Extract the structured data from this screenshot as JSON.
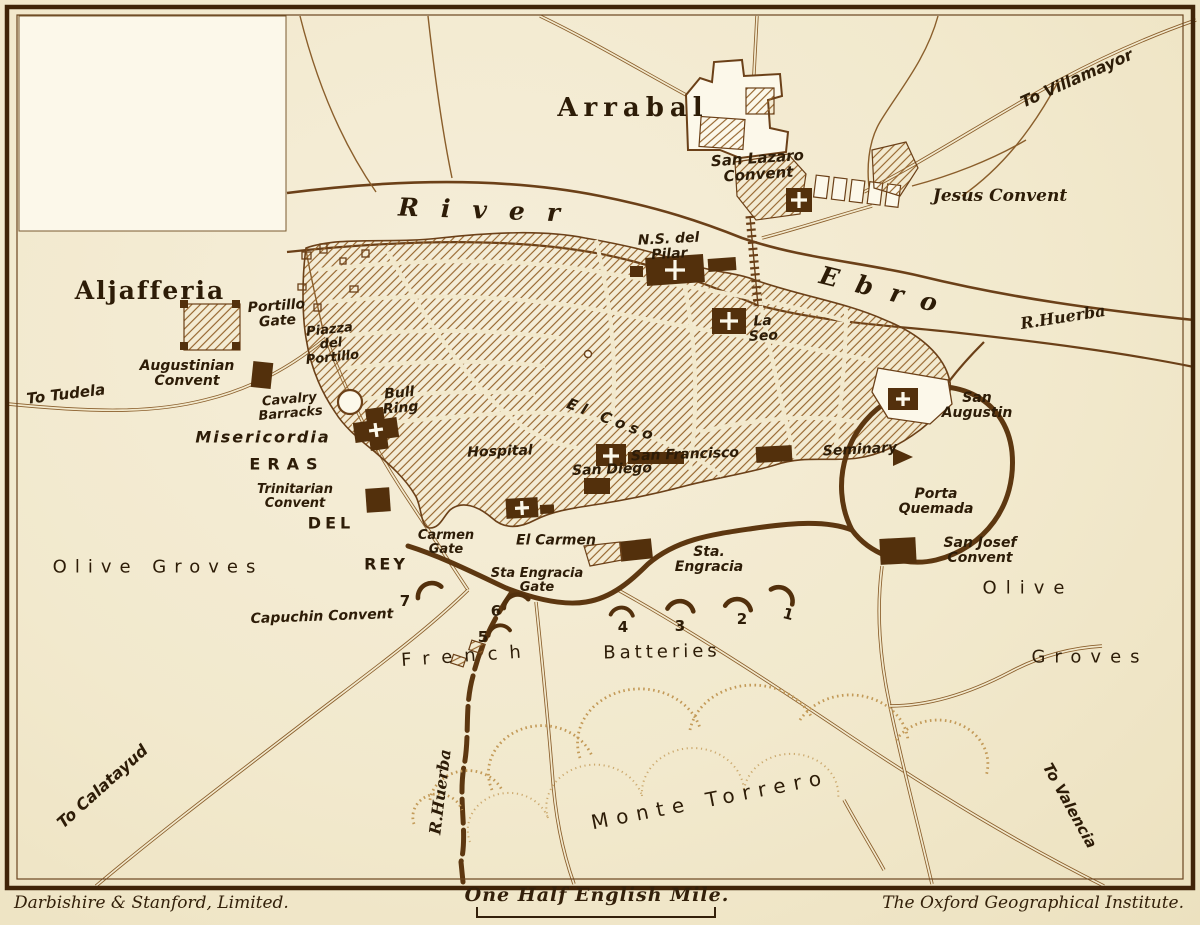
{
  "map": {
    "subject": "Siege map of Saragossa with French batteries",
    "labels": [
      {
        "id": "arrabal",
        "t": "Arrabal",
        "x": 633,
        "y": 109,
        "fs": 26,
        "ls": 6,
        "f": "serif",
        "w": 700
      },
      {
        "id": "river-word",
        "t": "River",
        "x": 490,
        "y": 211,
        "fs": 25,
        "ls": 22,
        "f": "serif",
        "it": 1,
        "w": 700,
        "rot": 2
      },
      {
        "id": "ebro-word",
        "t": "Ebro",
        "x": 887,
        "y": 292,
        "fs": 25,
        "ls": 18,
        "f": "serif",
        "it": 1,
        "w": 700,
        "rot": 14
      },
      {
        "id": "san-lazaro-convent",
        "t": "San Lazaro\nConvent",
        "x": 758,
        "y": 167,
        "fs": 15,
        "it": 1,
        "w": 700,
        "rot": -4
      },
      {
        "id": "to-villamayor",
        "t": "To Villamayor",
        "x": 1077,
        "y": 79,
        "fs": 16,
        "it": 1,
        "w": 600,
        "rot": -24
      },
      {
        "id": "jesus-convent",
        "t": "Jesus Convent",
        "x": 1000,
        "y": 196,
        "fs": 17,
        "f": "serif",
        "it": 1,
        "w": 600
      },
      {
        "id": "r-huerba-mouth",
        "t": "R.Huerba",
        "x": 1063,
        "y": 318,
        "fs": 16,
        "f": "serif",
        "it": 1,
        "w": 700,
        "rot": -9
      },
      {
        "id": "ns-del-pilar",
        "t": "N.S. del\nPilar",
        "x": 669,
        "y": 247,
        "fs": 14,
        "it": 1,
        "w": 700,
        "rot": -3
      },
      {
        "id": "la-seo",
        "t": "La\nSeo",
        "x": 763,
        "y": 329,
        "fs": 14,
        "it": 1,
        "w": 700,
        "rot": -3
      },
      {
        "id": "aljafferia",
        "t": "Aljafferia",
        "x": 150,
        "y": 291,
        "fs": 25,
        "ls": 2,
        "f": "serif",
        "w": 700
      },
      {
        "id": "portillo-gate",
        "t": "Portillo\nGate",
        "x": 277,
        "y": 314,
        "fs": 14,
        "it": 1,
        "w": 700,
        "rot": -4
      },
      {
        "id": "piazza-del-portillo",
        "t": "Piazza\ndel\nPortillo",
        "x": 331,
        "y": 344,
        "fs": 13,
        "it": 1,
        "w": 700,
        "rot": -6
      },
      {
        "id": "augustinian-convent",
        "t": "Augustinian\nConvent",
        "x": 187,
        "y": 374,
        "fs": 14,
        "it": 1,
        "w": 700
      },
      {
        "id": "to-tudela",
        "t": "To Tudela",
        "x": 66,
        "y": 395,
        "fs": 15,
        "it": 1,
        "w": 600,
        "rot": -7
      },
      {
        "id": "cavalry-barracks",
        "t": "Cavalry\nBarracks",
        "x": 290,
        "y": 407,
        "fs": 13,
        "it": 1,
        "w": 700,
        "rot": -5
      },
      {
        "id": "bull-ring",
        "t": "Bull\nRing",
        "x": 400,
        "y": 401,
        "fs": 14,
        "it": 1,
        "w": 700,
        "rot": -5
      },
      {
        "id": "misericordia",
        "t": "Misericordia",
        "x": 263,
        "y": 438,
        "fs": 16,
        "it": 1,
        "w": 700,
        "ls": 2
      },
      {
        "id": "eras",
        "t": "ERAS",
        "x": 287,
        "y": 465,
        "fs": 16,
        "ls": 7,
        "w": 700
      },
      {
        "id": "trinitarian-convent",
        "t": "Trinitarian\nConvent",
        "x": 295,
        "y": 497,
        "fs": 13,
        "it": 1,
        "w": 700
      },
      {
        "id": "del",
        "t": "DEL",
        "x": 331,
        "y": 524,
        "fs": 16,
        "ls": 4,
        "w": 700
      },
      {
        "id": "rey",
        "t": "REY",
        "x": 386,
        "y": 565,
        "fs": 16,
        "ls": 3,
        "w": 700
      },
      {
        "id": "olive-groves-west",
        "t": "Olive Groves",
        "x": 158,
        "y": 567,
        "fs": 18,
        "ls": 8,
        "w": 500
      },
      {
        "id": "carmen-gate",
        "t": "Carmen\nGate",
        "x": 446,
        "y": 543,
        "fs": 13,
        "it": 1,
        "w": 700
      },
      {
        "id": "el-carmen",
        "t": "El Carmen",
        "x": 556,
        "y": 541,
        "fs": 14,
        "it": 1,
        "w": 700
      },
      {
        "id": "sta-engracia-gate",
        "t": "Sta Engracia\nGate",
        "x": 537,
        "y": 581,
        "fs": 13,
        "it": 1,
        "w": 700
      },
      {
        "id": "capuchin-convent",
        "t": "Capuchin Convent",
        "x": 322,
        "y": 617,
        "fs": 14,
        "it": 1,
        "w": 700,
        "rot": -2
      },
      {
        "id": "hospital",
        "t": "Hospital",
        "x": 500,
        "y": 452,
        "fs": 14,
        "it": 1,
        "w": 700,
        "rot": -2
      },
      {
        "id": "san-diego",
        "t": "San Diego",
        "x": 612,
        "y": 470,
        "fs": 14,
        "it": 1,
        "w": 700,
        "rot": -2
      },
      {
        "id": "el-coso",
        "t": "El Coso",
        "x": 612,
        "y": 421,
        "fs": 15,
        "it": 1,
        "w": 700,
        "rot": 21,
        "ls": 5
      },
      {
        "id": "san-francisco",
        "t": "San Francisco",
        "x": 685,
        "y": 455,
        "fs": 14,
        "it": 1,
        "w": 700,
        "rot": -2
      },
      {
        "id": "seminary",
        "t": "Seminary",
        "x": 860,
        "y": 450,
        "fs": 14,
        "it": 1,
        "w": 700,
        "rot": -3
      },
      {
        "id": "san-augustin",
        "t": "San\nAugustin",
        "x": 977,
        "y": 406,
        "fs": 14,
        "it": 1,
        "w": 700
      },
      {
        "id": "porta-quemada",
        "t": "Porta\nQuemada",
        "x": 936,
        "y": 502,
        "fs": 14,
        "it": 1,
        "w": 700
      },
      {
        "id": "san-josef-convent",
        "t": "San Josef\nConvent",
        "x": 980,
        "y": 551,
        "fs": 14,
        "it": 1,
        "w": 700
      },
      {
        "id": "sta-engracia",
        "t": "Sta.\nEngracia",
        "x": 709,
        "y": 560,
        "fs": 14,
        "it": 1,
        "w": 700
      },
      {
        "id": "olive-east",
        "t": "Olive",
        "x": 1028,
        "y": 588,
        "fs": 18,
        "ls": 9,
        "w": 500
      },
      {
        "id": "groves-east",
        "t": "Groves",
        "x": 1090,
        "y": 657,
        "fs": 18,
        "ls": 9,
        "w": 500
      },
      {
        "id": "french",
        "t": "French",
        "x": 467,
        "y": 656,
        "fs": 18,
        "ls": 12,
        "w": 500,
        "rot": -4
      },
      {
        "id": "batteries",
        "t": "Batteries",
        "x": 662,
        "y": 652,
        "fs": 18,
        "ls": 4,
        "w": 500,
        "rot": -1
      },
      {
        "id": "battery-7",
        "t": "7",
        "x": 405,
        "y": 602,
        "fs": 15,
        "w": 700
      },
      {
        "id": "battery-6",
        "t": "6",
        "x": 496,
        "y": 612,
        "fs": 15,
        "w": 700
      },
      {
        "id": "battery-5",
        "t": "5",
        "x": 483,
        "y": 638,
        "fs": 15,
        "w": 700
      },
      {
        "id": "battery-4",
        "t": "4",
        "x": 623,
        "y": 628,
        "fs": 15,
        "w": 700
      },
      {
        "id": "battery-3",
        "t": "3",
        "x": 680,
        "y": 627,
        "fs": 15,
        "w": 700
      },
      {
        "id": "battery-2",
        "t": "2",
        "x": 742,
        "y": 620,
        "fs": 15,
        "w": 700
      },
      {
        "id": "battery-1",
        "t": "1",
        "x": 788,
        "y": 615,
        "fs": 15,
        "w": 700,
        "rot": 15
      },
      {
        "id": "monte-torrero",
        "t": "Monte Torrero",
        "x": 710,
        "y": 800,
        "fs": 20,
        "ls": 8,
        "w": 500,
        "rot": -11
      },
      {
        "id": "r-huerba-south",
        "t": "R.Huerba",
        "x": 441,
        "y": 792,
        "fs": 16,
        "f": "serif",
        "it": 1,
        "w": 700,
        "rot": -83
      },
      {
        "id": "to-calatayud",
        "t": "To Calatayud",
        "x": 103,
        "y": 787,
        "fs": 16,
        "it": 1,
        "w": 600,
        "rot": -42
      },
      {
        "id": "to-valencia",
        "t": "To Valencia",
        "x": 1069,
        "y": 806,
        "fs": 15,
        "it": 1,
        "w": 600,
        "rot": 61
      }
    ]
  },
  "scale_bar": {
    "label": "One Half English Mile."
  },
  "footer": {
    "publisher_left": "Darbishire & Stanford, Limited.",
    "publisher_right": "The Oxford Geographical Institute."
  },
  "colors": {
    "paper": "#f2e9cd",
    "paper_light": "#fcf8ea",
    "ink": "#33200a",
    "label": "#2d1c07",
    "road": "#8a5e2b",
    "road_dark": "#6b4018",
    "building": "#53300c",
    "wall": "#5d3710",
    "hatch": "#95652d",
    "stipple": "#c39a58",
    "frame": "#402408"
  }
}
